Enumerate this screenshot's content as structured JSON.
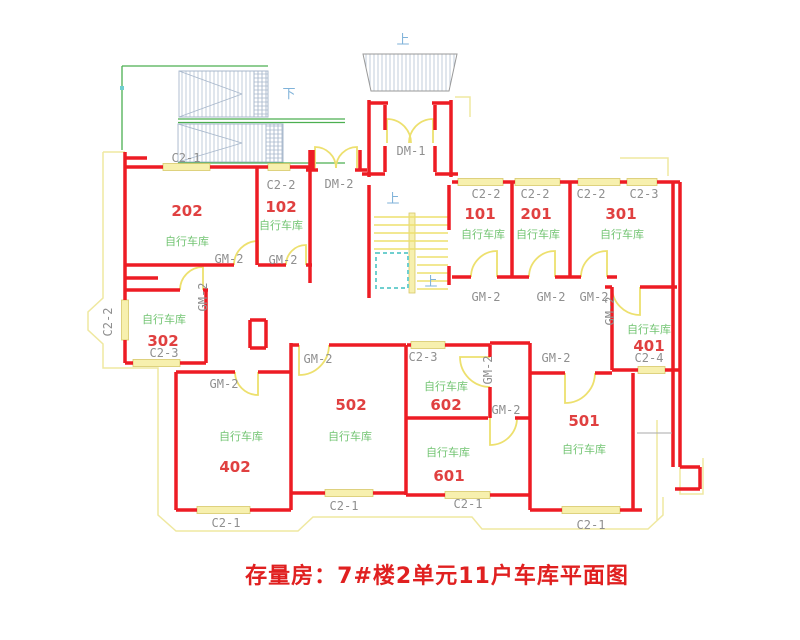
{
  "title": "存量房：7#楼2单元11户车库平面图",
  "labels": {
    "up": "上",
    "down": "下",
    "door_main": "DM-1",
    "door_side": "DM-2",
    "door_garage": "GM-2",
    "win_c21": "C2-1",
    "win_c22": "C2-2",
    "win_c23": "C2-3",
    "win_c24": "C2-4",
    "room_use": "自行车库"
  },
  "rooms": {
    "r101": "101",
    "r201": "201",
    "r301": "301",
    "r102": "102",
    "r202": "202",
    "r302": "302",
    "r402": "402",
    "r502": "502",
    "r602": "602",
    "r601": "601",
    "r501": "501",
    "r401": "401"
  },
  "colors": {
    "wall_red": "#ED1C24",
    "window_yellow": "#F7F0AE",
    "boundary_yellow": "#EFE8A0",
    "door_yellow": "#EDE06E",
    "label_gray": "#8F8F8F",
    "room_number_red": "#E04040",
    "room_use_green": "#72C472",
    "direction_blue": "#7FB2D9",
    "ramp_green": "#4CAF50",
    "hatch_blue_gray": "#A8B8CC",
    "elevator_cyan": "#6FCFCF",
    "title_red": "#E02020"
  }
}
